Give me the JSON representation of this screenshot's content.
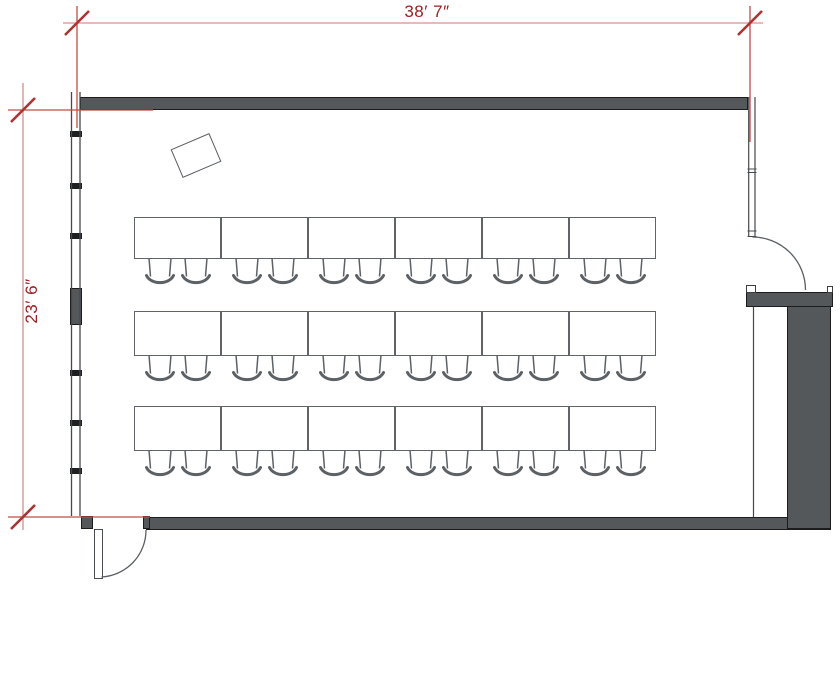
{
  "title": "Classroom floor plan",
  "dimensions": {
    "width_label": "38′ 7″",
    "height_label": "23′ 6″"
  },
  "furniture": {
    "table_rows": 3,
    "tables_per_row": 6,
    "chairs_per_table": 2,
    "total_tables": 18,
    "total_chairs": 36,
    "teacher_desk": 1
  },
  "architecture": {
    "doors": 2,
    "window_wall_side": "left",
    "window_mullions": 6
  },
  "colors": {
    "wall_fill": "#54585a",
    "wall_outline": "#1c1c1c",
    "furniture_line": "#5c6165",
    "window_line": "#45494d",
    "dim_line": "#dfa2a2",
    "dim_extension": "#c64a42",
    "dim_slash": "#a83434",
    "dim_text": "#9c2020"
  }
}
